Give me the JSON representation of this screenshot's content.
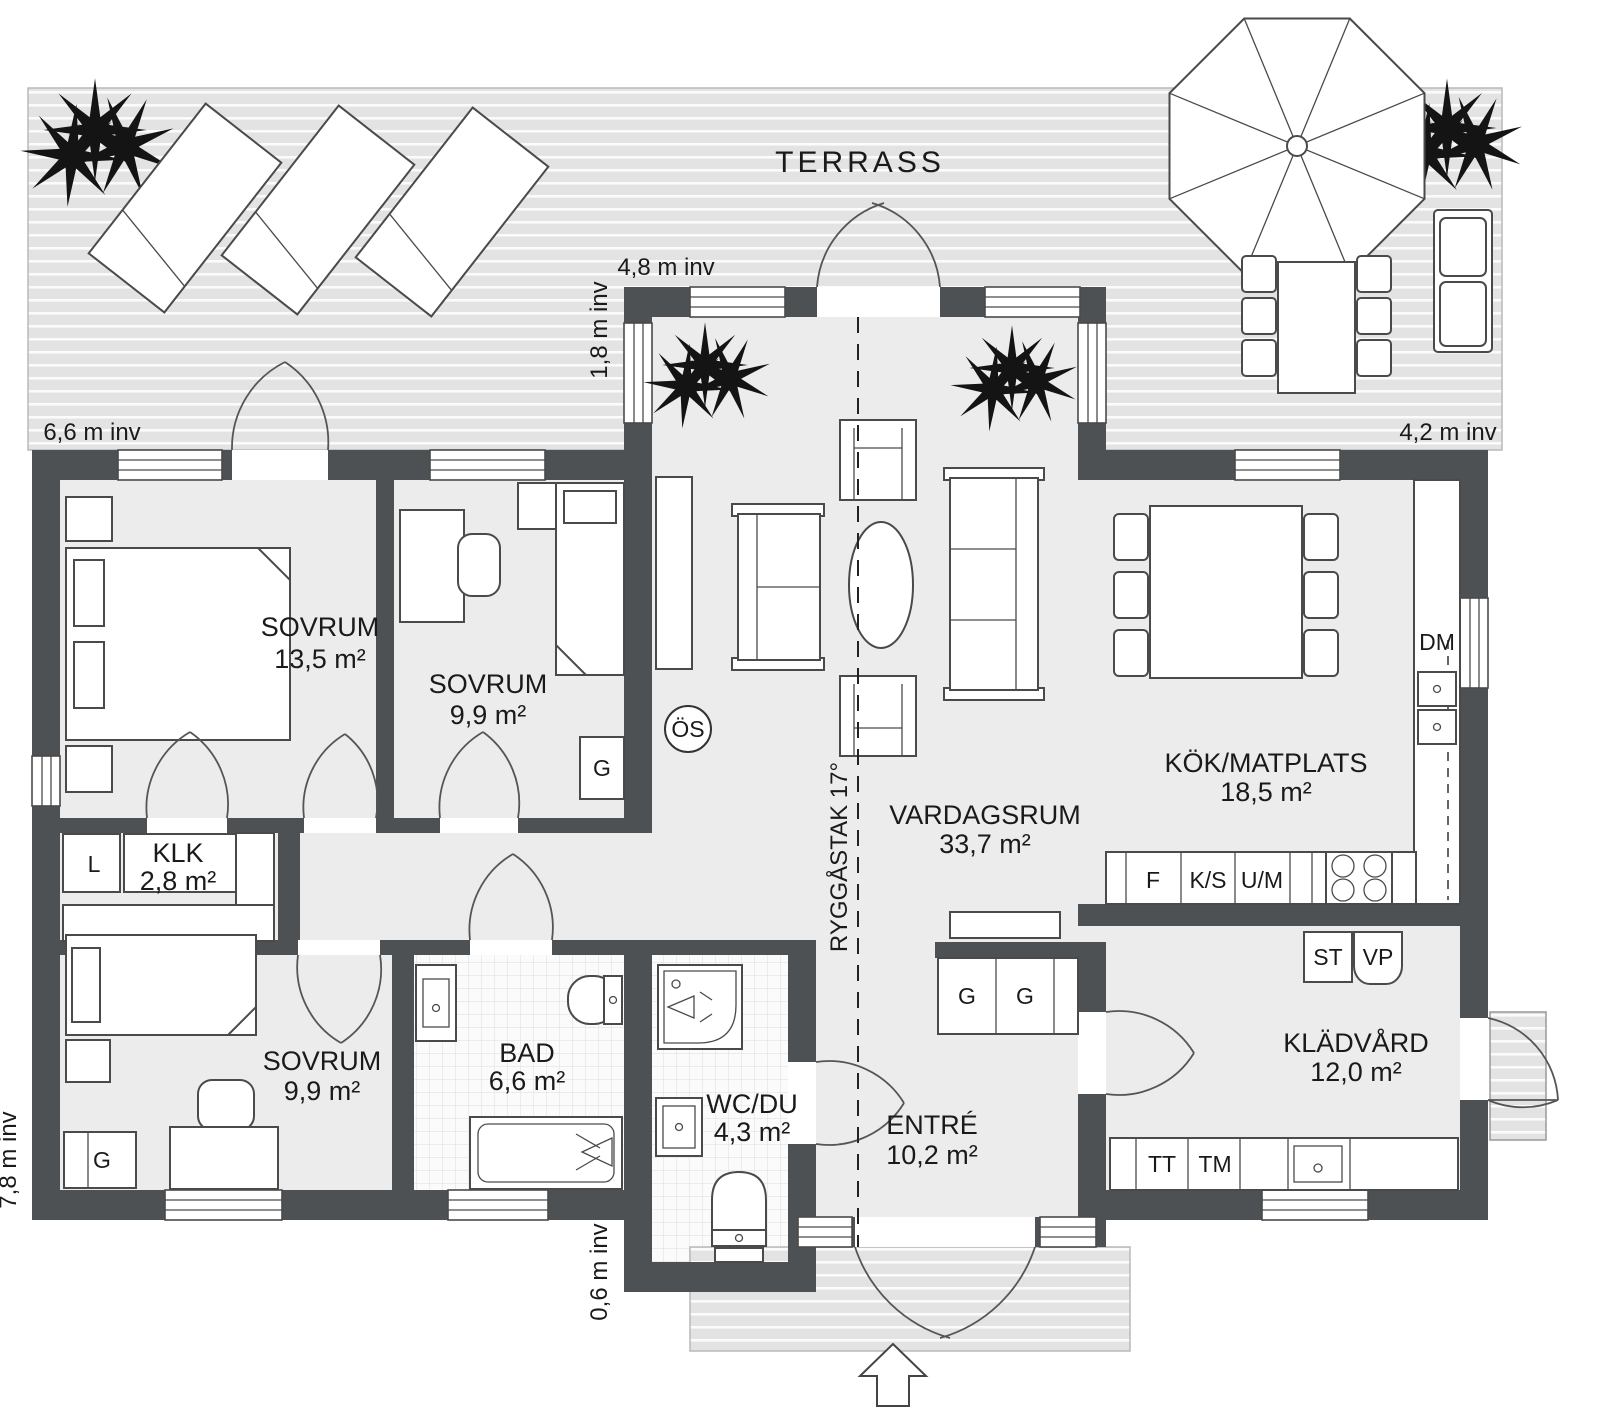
{
  "labels": {
    "terrace": "TERRASS",
    "os": "ÖS",
    "ridge": "RYGGÅSTAK 17°"
  },
  "dimensions": {
    "top": "4,8 m inv",
    "bay_side": "1,8 m inv",
    "left_top": "6,6 m inv",
    "right": "4,2 m inv",
    "left_bottom": "7,8 m inv",
    "bottom_center": "0,6 m inv"
  },
  "rooms": {
    "sovrum1": {
      "name": "SOVRUM",
      "area": "13,5 m²"
    },
    "sovrum2": {
      "name": "SOVRUM",
      "area": "9,9 m²"
    },
    "sovrum3": {
      "name": "SOVRUM",
      "area": "9,9 m²"
    },
    "klk": {
      "name": "KLK",
      "area": "2,8 m²"
    },
    "bad": {
      "name": "BAD",
      "area": "6,6 m²"
    },
    "wcdu": {
      "name": "WC/DU",
      "area": "4,3 m²"
    },
    "entre": {
      "name": "ENTRÉ",
      "area": "10,2 m²"
    },
    "vardagsrum": {
      "name": "VARDAGSRUM",
      "area": "33,7 m²"
    },
    "kok": {
      "name": "KÖK/MATPLATS",
      "area": "18,5 m²"
    },
    "kladvard": {
      "name": "KLÄDVÅRD",
      "area": "12,0 m²"
    }
  },
  "fixtures": {
    "dm": "DM",
    "f": "F",
    "ks": "K/S",
    "um": "U/M",
    "st": "ST",
    "vp": "VP",
    "tt": "TT",
    "tm": "TM",
    "l": "L",
    "g": "G"
  },
  "colors": {
    "wall": "#4d5154",
    "floor": "#ececec",
    "deck": "#e3e3e3",
    "stroke": "#4a4a4a",
    "ink": "#1a1a1a"
  }
}
